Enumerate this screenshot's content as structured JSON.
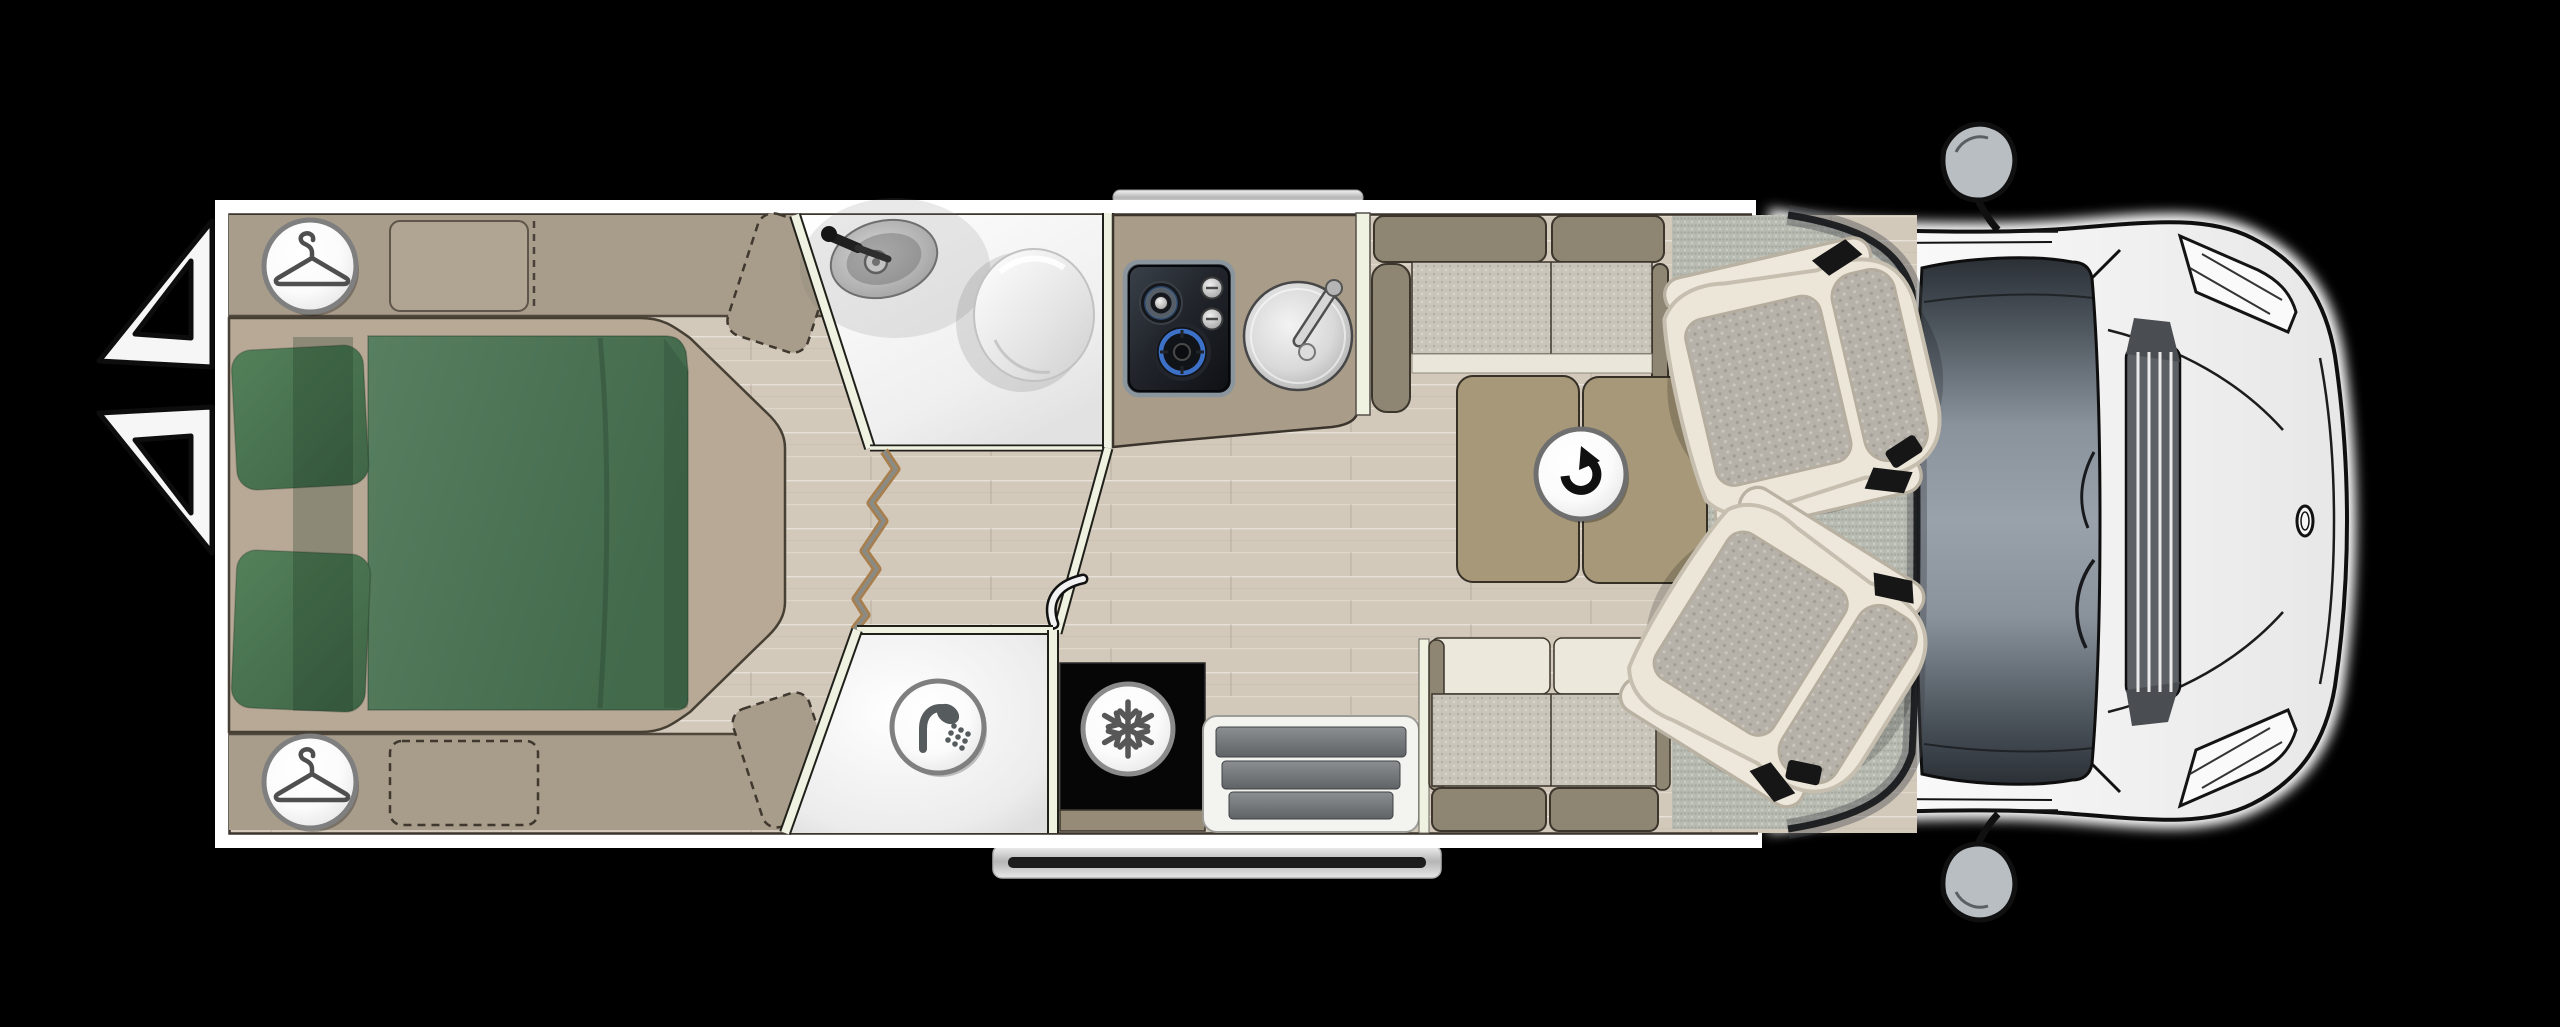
{
  "scene": {
    "name": "motorhome-floorplan-top-view",
    "vehicle": "coachbuilt-camper-van"
  },
  "rooms": [
    {
      "id": "bedroom",
      "label": "Rear bedroom"
    },
    {
      "id": "washroom",
      "label": "Washroom"
    },
    {
      "id": "shower",
      "label": "Shower cubicle"
    },
    {
      "id": "kitchen",
      "label": "Kitchen"
    },
    {
      "id": "dinette",
      "label": "Dinette"
    },
    {
      "id": "cab",
      "label": "Driver cab"
    }
  ],
  "icons": [
    {
      "id": "wardrobe-top",
      "label": "Wardrobe",
      "glyph": "hanger"
    },
    {
      "id": "wardrobe-bottom",
      "label": "Wardrobe",
      "glyph": "hanger"
    },
    {
      "id": "shower",
      "label": "Shower",
      "glyph": "shower-head"
    },
    {
      "id": "fridge",
      "label": "Fridge",
      "glyph": "snowflake"
    },
    {
      "id": "swivel-table",
      "label": "Swivel table",
      "glyph": "rotate-arrow"
    }
  ],
  "palette": {
    "background": "#000000",
    "wall_white": "#ffffff",
    "floor_wood": "#d3c9bb",
    "cab_carpet": "#b8bbb1",
    "furniture_taupe": "#a99c89",
    "bed_platform": "#b7a996",
    "duvet_green": "#4b7354",
    "cushion_fabric": "#c9c5bb",
    "khaki_upholstery": "#8e8573",
    "ivory_upholstery": "#eae7da",
    "cream_partition": "#f0f2e1",
    "hob_burner_blue": "#3d71c8",
    "windshield_grey": "#7e8791"
  }
}
